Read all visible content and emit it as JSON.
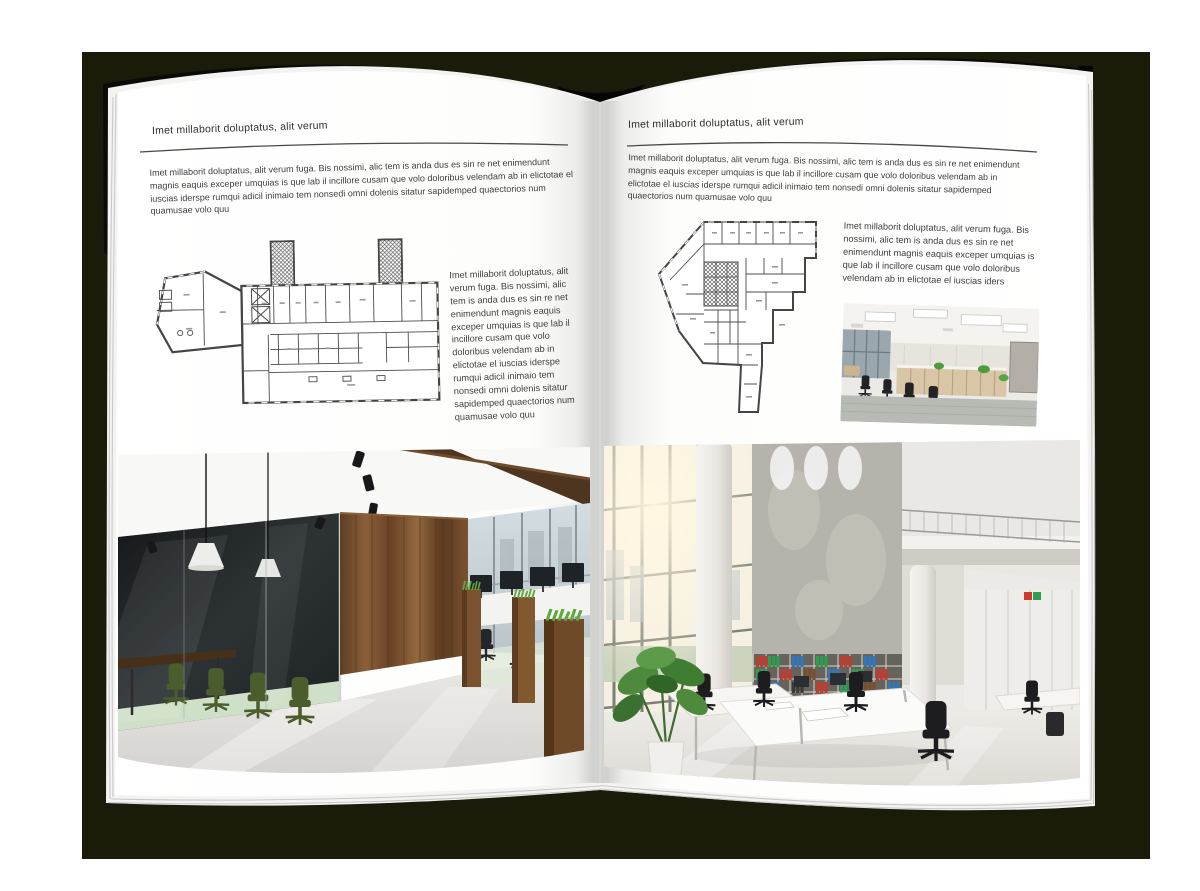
{
  "background": {
    "outer": "#ffffff",
    "mat": "#1a1b08"
  },
  "left_page": {
    "header": "Imet millaborit doluptatus, alit verum",
    "intro": "Imet millaborit doluptatus, alit verum fuga. Bis nossimi, alic tem is anda dus es sin re net enimendunt magnis eaquis exceper umquias is que lab il incillore cusam que volo doloribus velendam ab in elictotae el iuscias iderspe rumqui adicil inimaio tem nonsedi omni dolenis sitatur sapidemped quaectorios num quamusae volo quu",
    "side_text": "Imet millaborit doluptatus, alit verum fuga. Bis nossimi, alic tem is anda dus es sin re net enimendunt magnis eaquis exceper umquias is que lab il incillore cusam que volo doloribus velendam ab in elictotae el iuscias iderspe rumqui adicil inimaio tem nonsedi omni dolenis sitatur sapidemped quaectorios num quamusae volo quu",
    "floor_plan": "architectural-floor-plan-wing-building",
    "photo": "loft-office-interior-with-glass-meeting-room"
  },
  "right_page": {
    "header": "Imet millaborit doluptatus, alit verum",
    "intro": "Imet millaborit doluptatus, alit verum fuga. Bis nossimi, alic tem is anda dus es sin re net enimendunt magnis eaquis exceper umquias is que lab il incillore cusam que volo doloribus velendam ab in elictotae el iuscias iderspe rumqui adicil inimaio tem nonsedi omni dolenis sitatur sapidemped quaectorios num quamusae volo quu",
    "side_text": "Imet millaborit doluptatus, alit verum fuga. Bis nossimi, alic tem is anda dus es sin re net enimendunt magnis eaquis exceper umquias is que lab il incillore cusam que volo doloribus velendam ab in elictotae el iuscias iders",
    "floor_plan": "architectural-floor-plan-irregular-building",
    "photo_small": "white-open-plan-office-photo",
    "photo_large": "bright-double-height-office-atrium-photo"
  }
}
